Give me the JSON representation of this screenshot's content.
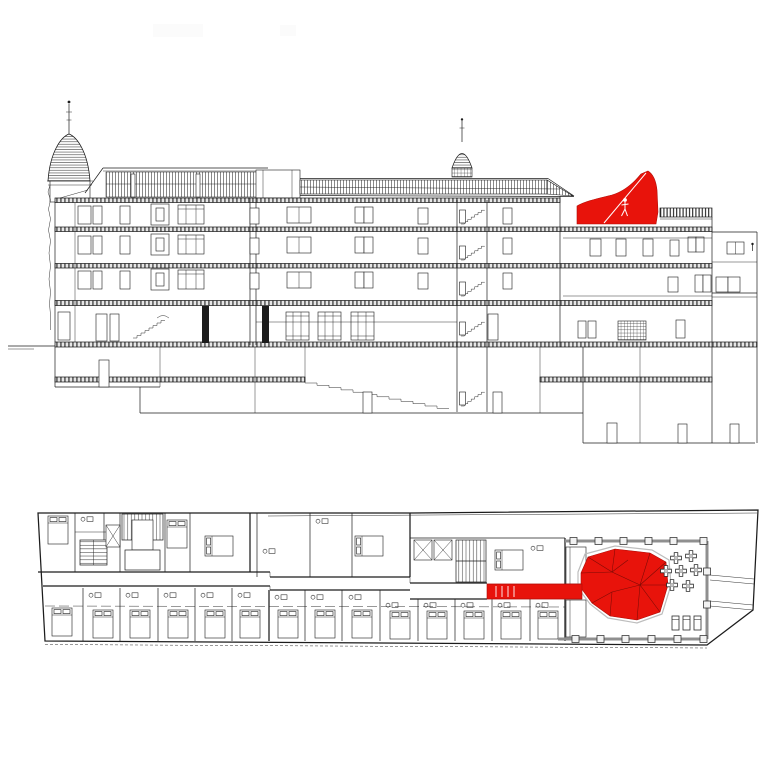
{
  "palette": {
    "highlight_red": "#e8130b",
    "line_black": "#1c1c1c",
    "colonnade_gray": "#8f8f8f",
    "slab_gray": "#9a9a9a"
  },
  "views": {
    "section": {
      "name": "building longitudinal section",
      "floors_above_ground": 5,
      "highlight": "red rooftop pavilion",
      "person_icon": "walking-person-icon"
    },
    "plan": {
      "name": "floor plan with terrace",
      "highlight": "red faceted pavilion canopy",
      "terrace_tables": 7,
      "terrace_loungers": 3
    }
  }
}
